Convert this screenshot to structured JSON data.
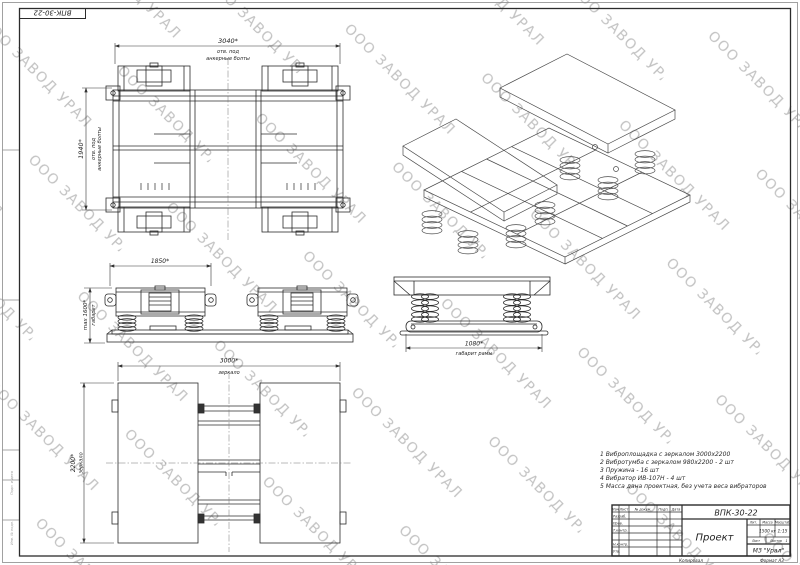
{
  "watermark": {
    "text": "ООО ЗАВОД УРАЛ"
  },
  "stamp_top_left": "ВПК-30-22",
  "frame": {
    "left_label_1": "Подп. и дата",
    "left_label_2": "Инв. № подл."
  },
  "views": {
    "top_view": {
      "dim_width": "3040*",
      "dim_width_note1": "отв. под",
      "dim_width_note2": "анкерные болты",
      "dim_height": "1940*"
    },
    "front_view": {
      "dim_width": "1850*",
      "dim_height": "max 1600*",
      "dim_height_note": "габарит"
    },
    "side_view": {
      "dim_width": "1080*",
      "dim_width_note": "габарит рамы"
    },
    "bottom_view": {
      "dim_width": "3000*",
      "dim_width_note": "зеркало",
      "dim_height": "2200*",
      "dim_height_note": "зеркало"
    }
  },
  "notes": [
    "1 Виброплощадка с зеркалом 3000х2200",
    "2 Вибротумба с зеркалом 980х2200 - 2 шт",
    "3 Пружина - 16 шт",
    "4 Вибратор ИВ-107Н - 4 шт",
    "5 Масса дана проектная, без учета веса вибраторов"
  ],
  "title_block": {
    "designation": "ВПК-30-22",
    "name": "Проект",
    "col_lit": "Лит.",
    "col_mass": "Масса",
    "col_scale": "Масштаб",
    "mass": "1500 кг",
    "scale": "1:15",
    "sheet_label": "Лист",
    "sheets_label": "Листов",
    "sheets_value": "1",
    "org": "МЗ \"Урал\"",
    "header_cols": [
      "Изм",
      "Лист",
      "№ докум.",
      "Подп.",
      "Дата"
    ],
    "rows": [
      "Разраб.",
      "Пров.",
      "Т.контр.",
      "Н.контр.",
      "Утв."
    ],
    "copied": "Копировал",
    "format": "Формат А3"
  }
}
